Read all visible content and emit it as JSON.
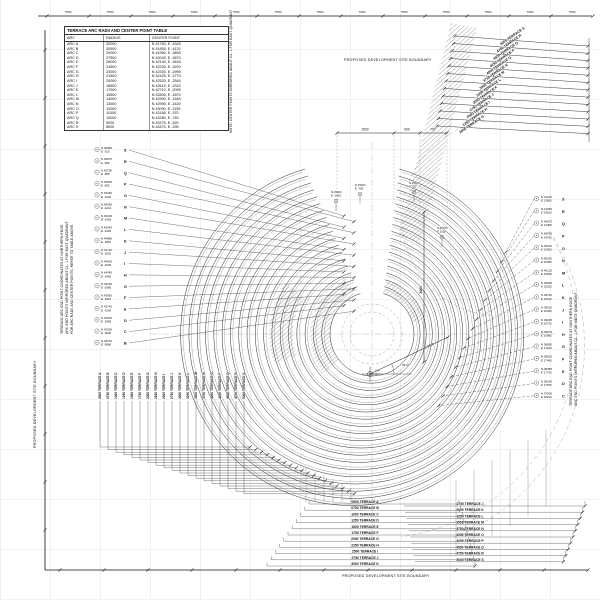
{
  "sheet": {
    "boundary_label": "PROPOSED DEVELOPMENT SITE BOUNDARY",
    "ruler_value": "7500"
  },
  "table": {
    "title": "TERRACE ARC RADII AND CENTER POINT TABLE",
    "columns": [
      "ARC",
      "RADIUS",
      "CENTER POINT"
    ],
    "note": "NOTE: CENTER POINTS MIRRORED ABOUT CL. 1 FOR EAST QUADRANT",
    "rows": [
      {
        "arc": "ARC A",
        "radius": "32000",
        "center": "N 41760, E -4345"
      },
      {
        "arc": "ARC B",
        "radius": "30500",
        "center": "N 41855, E -4120"
      },
      {
        "arc": "ARC C",
        "radius": "29000",
        "center": "N 41950, E -3895"
      },
      {
        "arc": "ARC D",
        "radius": "27500",
        "center": "N 42045, E -3670"
      },
      {
        "arc": "ARC E",
        "radius": "26000",
        "center": "N 42140, E -3445"
      },
      {
        "arc": "ARC F",
        "radius": "24500",
        "center": "N 42235, E -3220"
      },
      {
        "arc": "ARC G",
        "radius": "23000",
        "center": "N 42330, E -2995"
      },
      {
        "arc": "ARC H",
        "radius": "21500",
        "center": "N 42425, E -2770"
      },
      {
        "arc": "ARC I",
        "radius": "20000",
        "center": "N 42520, E -2545"
      },
      {
        "arc": "ARC J",
        "radius": "18500",
        "center": "N 42615, E -2320"
      },
      {
        "arc": "ARC K",
        "radius": "17000",
        "center": "N 42710, E -2095"
      },
      {
        "arc": "ARC L",
        "radius": "15500",
        "center": "N 42805, E -1870"
      },
      {
        "arc": "ARC M",
        "radius": "14000",
        "center": "N 42900, E -1645"
      },
      {
        "arc": "ARC N",
        "radius": "13000",
        "center": "N 42995, E -1420"
      },
      {
        "arc": "ARC O",
        "radius": "12000",
        "center": "N 43090, E -1195"
      },
      {
        "arc": "ARC P",
        "radius": "11000",
        "center": "N 43185, E -970"
      },
      {
        "arc": "ARC Q",
        "radius": "10000",
        "center": "N 43280, E -745"
      },
      {
        "arc": "ARC R",
        "radius": "9000",
        "center": "N 43375, E -520"
      },
      {
        "arc": "ARC S",
        "radius": "8500",
        "center": "N 43470, E -295"
      }
    ]
  },
  "notes": {
    "left_lines": [
      "TERRACE ARC END POINT COORDINATES AT NORTHERN EDGE",
      "ARC END POINTS MIRRORED ABOUT CL. 1 FOR EAST QUADRANT",
      "FOR ARC RADII AND CENTER POINTS, REFER TO TABLE ABOVE"
    ],
    "right_lines": [
      "TERRACE ARC END POINT COORDINATES AT SOUTHERN EDGE",
      "ARC END POINTS MIRRORED ABOUT CL. 1 FOR WEST QUADRANT"
    ]
  },
  "callouts": {
    "left": [
      {
        "letter": "S",
        "n": "N 45980",
        "e": "E -310"
      },
      {
        "letter": "R",
        "n": "N 45870",
        "e": "E -480"
      },
      {
        "letter": "Q",
        "n": "N 45750",
        "e": "E -655"
      },
      {
        "letter": "P",
        "n": "N 45625",
        "e": "E -835"
      },
      {
        "letter": "O",
        "n": "N 45490",
        "e": "E -1020"
      },
      {
        "letter": "N",
        "n": "N 45350",
        "e": "E -1210"
      },
      {
        "letter": "M",
        "n": "N 45200",
        "e": "E -1405"
      },
      {
        "letter": "L",
        "n": "N 45045",
        "e": "E -1605"
      },
      {
        "letter": "K",
        "n": "N 44880",
        "e": "E -1810"
      },
      {
        "letter": "J",
        "n": "N 44710",
        "e": "E -2020"
      },
      {
        "letter": "I",
        "n": "N 44530",
        "e": "E -2235"
      },
      {
        "letter": "H",
        "n": "N 44345",
        "e": "E -2455"
      },
      {
        "letter": "G",
        "n": "N 44150",
        "e": "E -2680"
      },
      {
        "letter": "F",
        "n": "N 43950",
        "e": "E -2910"
      },
      {
        "letter": "E",
        "n": "N 43740",
        "e": "E -3145"
      },
      {
        "letter": "D",
        "n": "N 43525",
        "e": "E -3385"
      },
      {
        "letter": "C",
        "n": "N 43300",
        "e": "E -3630"
      },
      {
        "letter": "B",
        "n": "N 43070",
        "e": "E -3880"
      }
    ],
    "right": [
      {
        "letter": "S",
        "n": "N 41220",
        "e": "E 13850"
      },
      {
        "letter": "R",
        "n": "N 41050",
        "e": "E 14160"
      },
      {
        "letter": "Q",
        "n": "N 40875",
        "e": "E 14465"
      },
      {
        "letter": "P",
        "n": "N 40695",
        "e": "E 14765"
      },
      {
        "letter": "O",
        "n": "N 40510",
        "e": "E 15060"
      },
      {
        "letter": "N",
        "n": "N 40320",
        "e": "E 15350"
      },
      {
        "letter": "M",
        "n": "N 40125",
        "e": "E 15635"
      },
      {
        "letter": "L",
        "n": "N 39925",
        "e": "E 15915"
      },
      {
        "letter": "K",
        "n": "N 39720",
        "e": "E 16190"
      },
      {
        "letter": "J",
        "n": "N 39510",
        "e": "E 16460"
      },
      {
        "letter": "I",
        "n": "N 39295",
        "e": "E 16725"
      },
      {
        "letter": "H",
        "n": "N 39075",
        "e": "E 16985"
      },
      {
        "letter": "G",
        "n": "N 38850",
        "e": "E 17240"
      },
      {
        "letter": "F",
        "n": "N 38620",
        "e": "E 17490"
      },
      {
        "letter": "E",
        "n": "N 38385",
        "e": "E 17735"
      },
      {
        "letter": "D",
        "n": "N 38145",
        "e": "E 17975"
      },
      {
        "letter": "C",
        "n": "N 37900",
        "e": "E 18210"
      }
    ],
    "top": [
      {
        "n": "N 45464",
        "e": "E -1500"
      },
      {
        "n": "N 45464",
        "e": "E -750"
      },
      {
        "n": "N 45464",
        "e": "E 750"
      },
      {
        "n": "N 45073",
        "e": "E 1500"
      }
    ]
  },
  "terraces": {
    "top_right": [
      "5000 TERRACE S",
      "4750 TERRACE R",
      "4500 TERRACE Q",
      "4250 TERRACE P",
      "4000 TERRACE O",
      "3750 TERRACE N",
      "3500 TERRACE M",
      "3250 TERRACE L",
      "3000 TERRACE K",
      "2750 TERRACE J",
      "2500 TERRACE I",
      "2250 TERRACE H",
      "2000 TERRACE G"
    ],
    "bottom_left": [
      "0500 TERRACE A",
      "0750 TERRACE B",
      "1000 TERRACE C",
      "1250 TERRACE D",
      "1500 TERRACE E",
      "1750 TERRACE F",
      "2000 TERRACE G",
      "2250 TERRACE H",
      "2500 TERRACE I",
      "2750 TERRACE J",
      "3000 TERRACE K",
      "3250 TERRACE L",
      "3500 TERRACE M",
      "3750 TERRACE N",
      "4000 TERRACE O",
      "4250 TERRACE P",
      "4500 TERRACE Q",
      "4750 TERRACE R",
      "5000 TERRACE S"
    ],
    "bottom_center_left": [
      "0500 TERRACE A",
      "0750 TERRACE B",
      "1000 TERRACE C",
      "1250 TERRACE D",
      "1500 TERRACE E",
      "1750 TERRACE F",
      "2000 TERRACE G",
      "2250 TERRACE H",
      "2500 TERRACE I",
      "2750 TERRACE J",
      "3000 TERRACE K"
    ],
    "bottom_center_right": [
      "2750 TERRACE J",
      "3000 TERRACE K",
      "3250 TERRACE L",
      "3500 TERRACE M",
      "3750 TERRACE N",
      "4000 TERRACE O",
      "4250 TERRACE P",
      "4500 TERRACE Q",
      "4750 TERRACE R",
      "5000 TERRACE S"
    ]
  },
  "dims": {
    "top_segments": [
      "1500",
      "900",
      "750"
    ],
    "vertical": "3464",
    "angle": "45.0°",
    "radial": "R 8500",
    "origin_n": "N 0",
    "origin_e": "E 0"
  },
  "colors": {
    "line": "#1a1a1a",
    "light": "#888",
    "hatch": "#444"
  }
}
